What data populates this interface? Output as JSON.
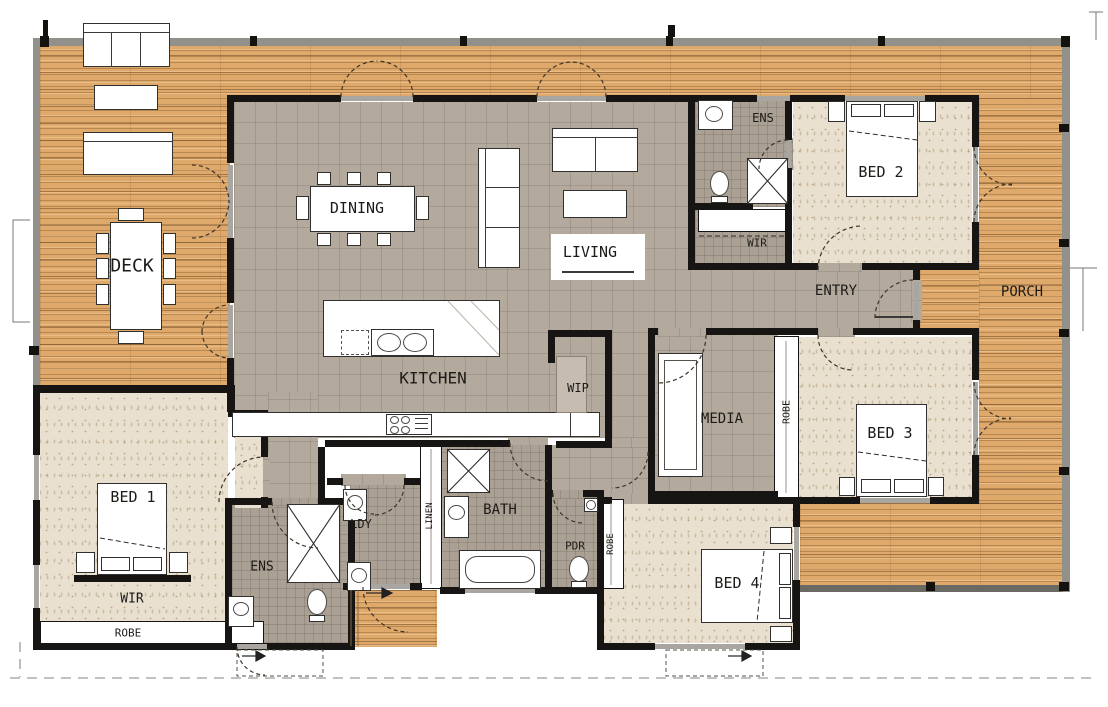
{
  "colors": {
    "deck_wood": "#e0a96c",
    "deck_stripe": "#8f6a3c",
    "rail_gray": "#92908a",
    "tile_living": "#b3a99d",
    "tile_wet": "#aba094",
    "carpet": "#e9e0d0",
    "wall_black": "#171513",
    "furniture_white": "#ffffff",
    "label_ink": "#1d1b18",
    "boundary_dash": "#9c9c9c"
  },
  "rooms": {
    "deck": "DECK",
    "dining": "DINING",
    "living": "LIVING",
    "kitchen": "KITCHEN",
    "pantry": "WIP",
    "entry": "ENTRY",
    "porch": "PORCH",
    "media": "MEDIA",
    "bath": "BATH",
    "laundry": "LDY",
    "linen": "LINEN",
    "powder": "PDR",
    "ensuite": "ENS",
    "walk_in_robe": "WIR",
    "robe": "ROBE",
    "bed1": "BED 1",
    "bed2": "BED 2",
    "bed3": "BED 3",
    "bed4": "BED 4"
  }
}
